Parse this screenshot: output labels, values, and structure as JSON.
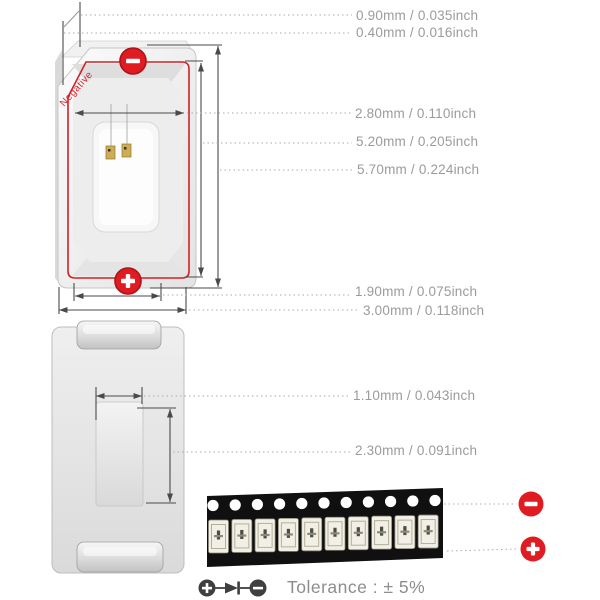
{
  "title_implicit": "SMD LED package dimension diagram",
  "front_view": {
    "negative_label": "Negative",
    "polarity_top": "minus",
    "polarity_bottom": "plus"
  },
  "dimension_labels": [
    {
      "text": "0.90mm / 0.035inch"
    },
    {
      "text": "0.40mm / 0.016inch"
    },
    {
      "text": "2.80mm / 0.110inch"
    },
    {
      "text": "5.20mm / 0.205inch"
    },
    {
      "text": "5.70mm / 0.224inch"
    },
    {
      "text": "1.90mm / 0.075inch"
    },
    {
      "text": "3.00mm / 0.118inch"
    },
    {
      "text": "1.10mm / 0.043inch"
    },
    {
      "text": "2.30mm / 0.091inch"
    }
  ],
  "tape": {
    "hole_count": 11,
    "led_count": 10
  },
  "tolerance_text": "Tolerance : ± 5%",
  "colors": {
    "accent_red": "#e01b22",
    "accent_red_dark": "#a8141a",
    "dim_line": "#4a4a4a",
    "leader_gray": "#ababab",
    "label_gray": "#9b9b9b",
    "tape_black": "#101010",
    "led_body": "#f2f0e6",
    "legend_gray": "#3f3f3f"
  }
}
